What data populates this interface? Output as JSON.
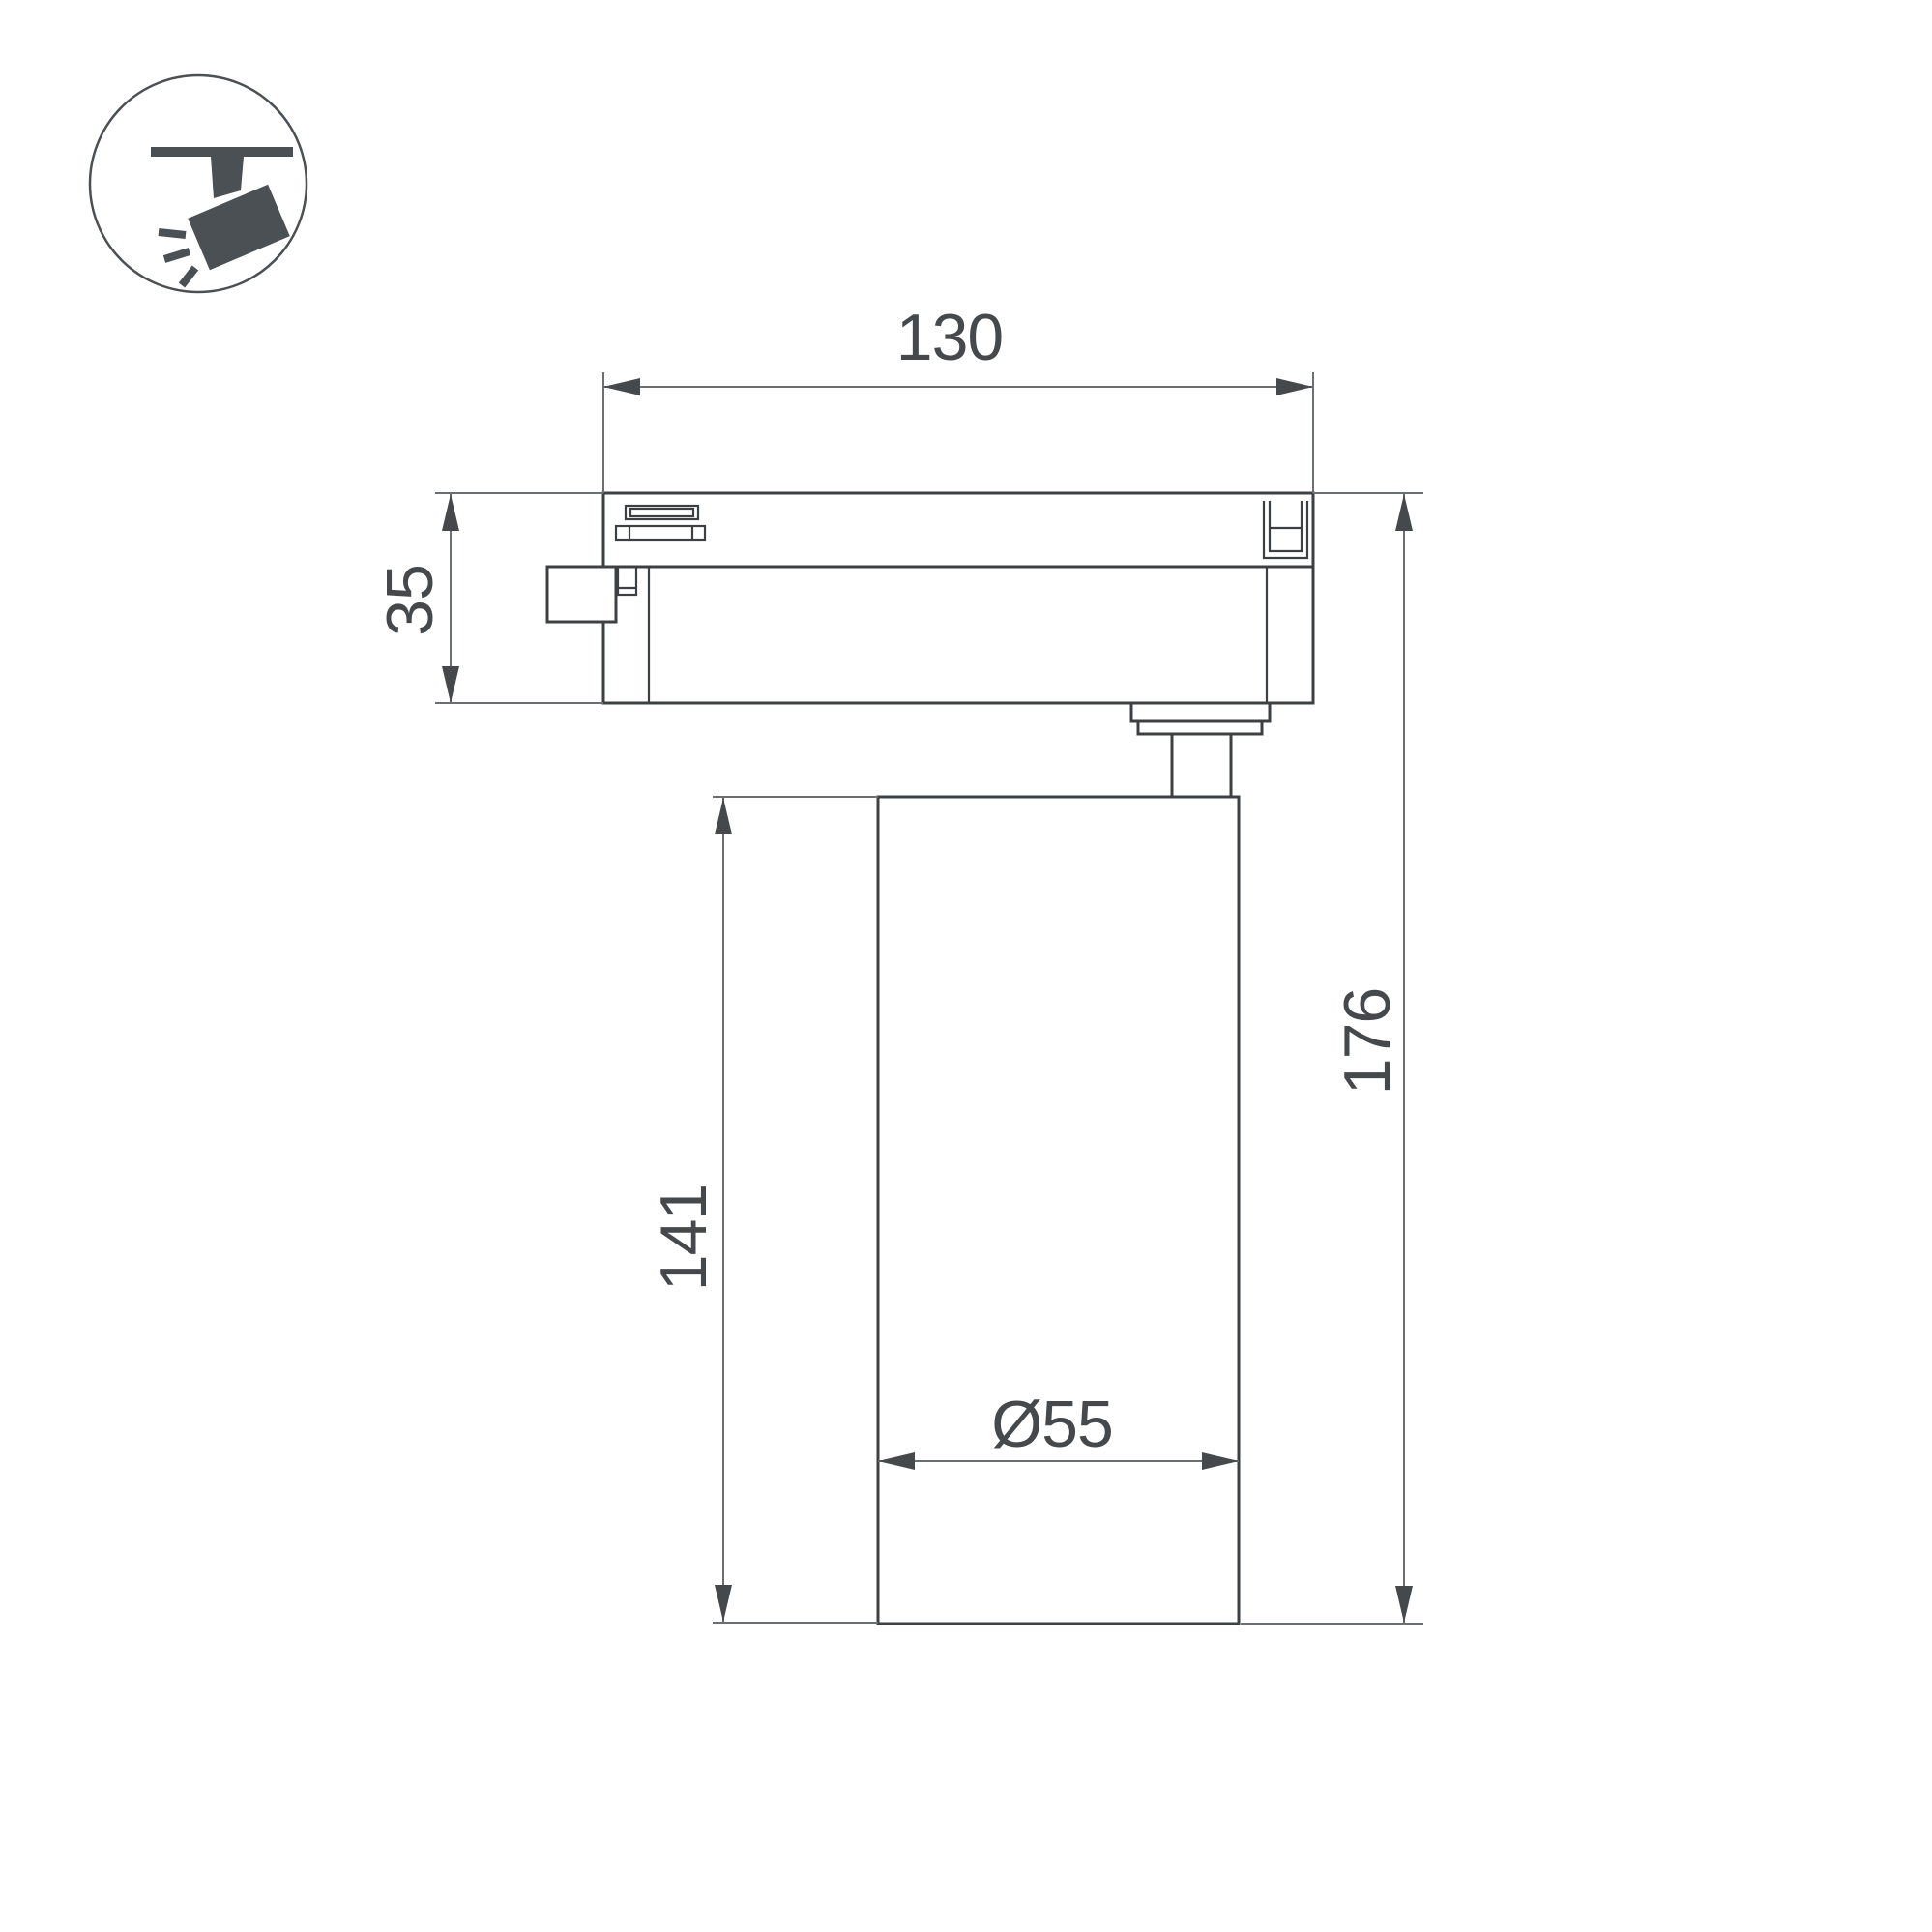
{
  "icon": {
    "name": "ceiling-track-spotlight",
    "color": "#4b5055"
  },
  "drawing": {
    "line_color": "#3c4043",
    "dim_line_color": "#6d7073",
    "text_color": "#46494c",
    "dimensions": {
      "track_width": "130",
      "adapter_height": "35",
      "body_height": "141",
      "total_height": "176",
      "body_diameter": "Ø55"
    }
  }
}
